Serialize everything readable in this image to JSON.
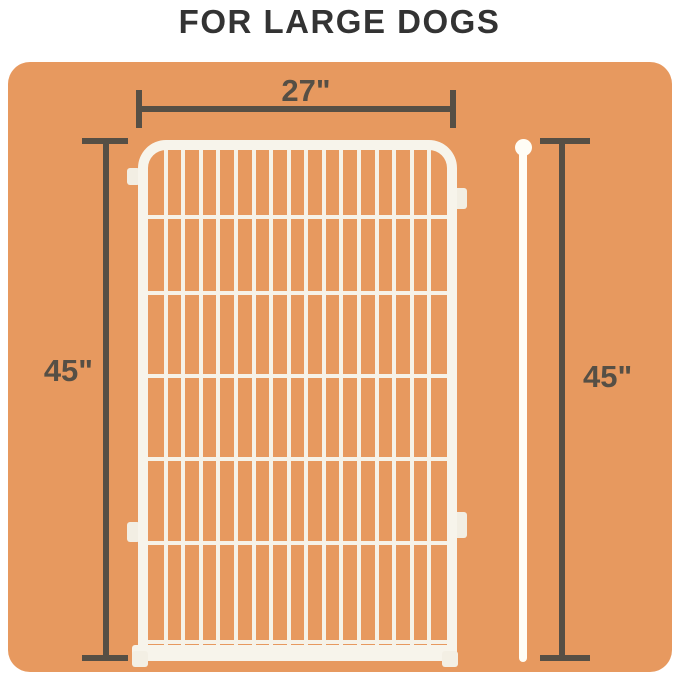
{
  "title": "FOR LARGE DOGS",
  "diagram": {
    "subject": "wire-fence-panel",
    "width_label": "27\"",
    "left_height_label": "45\"",
    "right_height_label": "45\"",
    "colors": {
      "page_background": "#FFFFFF",
      "card_background": "#E7995F",
      "dimension": "#564F45",
      "title_text": "#333333",
      "panel_white": "#F7F4EB",
      "rod_white": "#FFFDF5"
    }
  }
}
